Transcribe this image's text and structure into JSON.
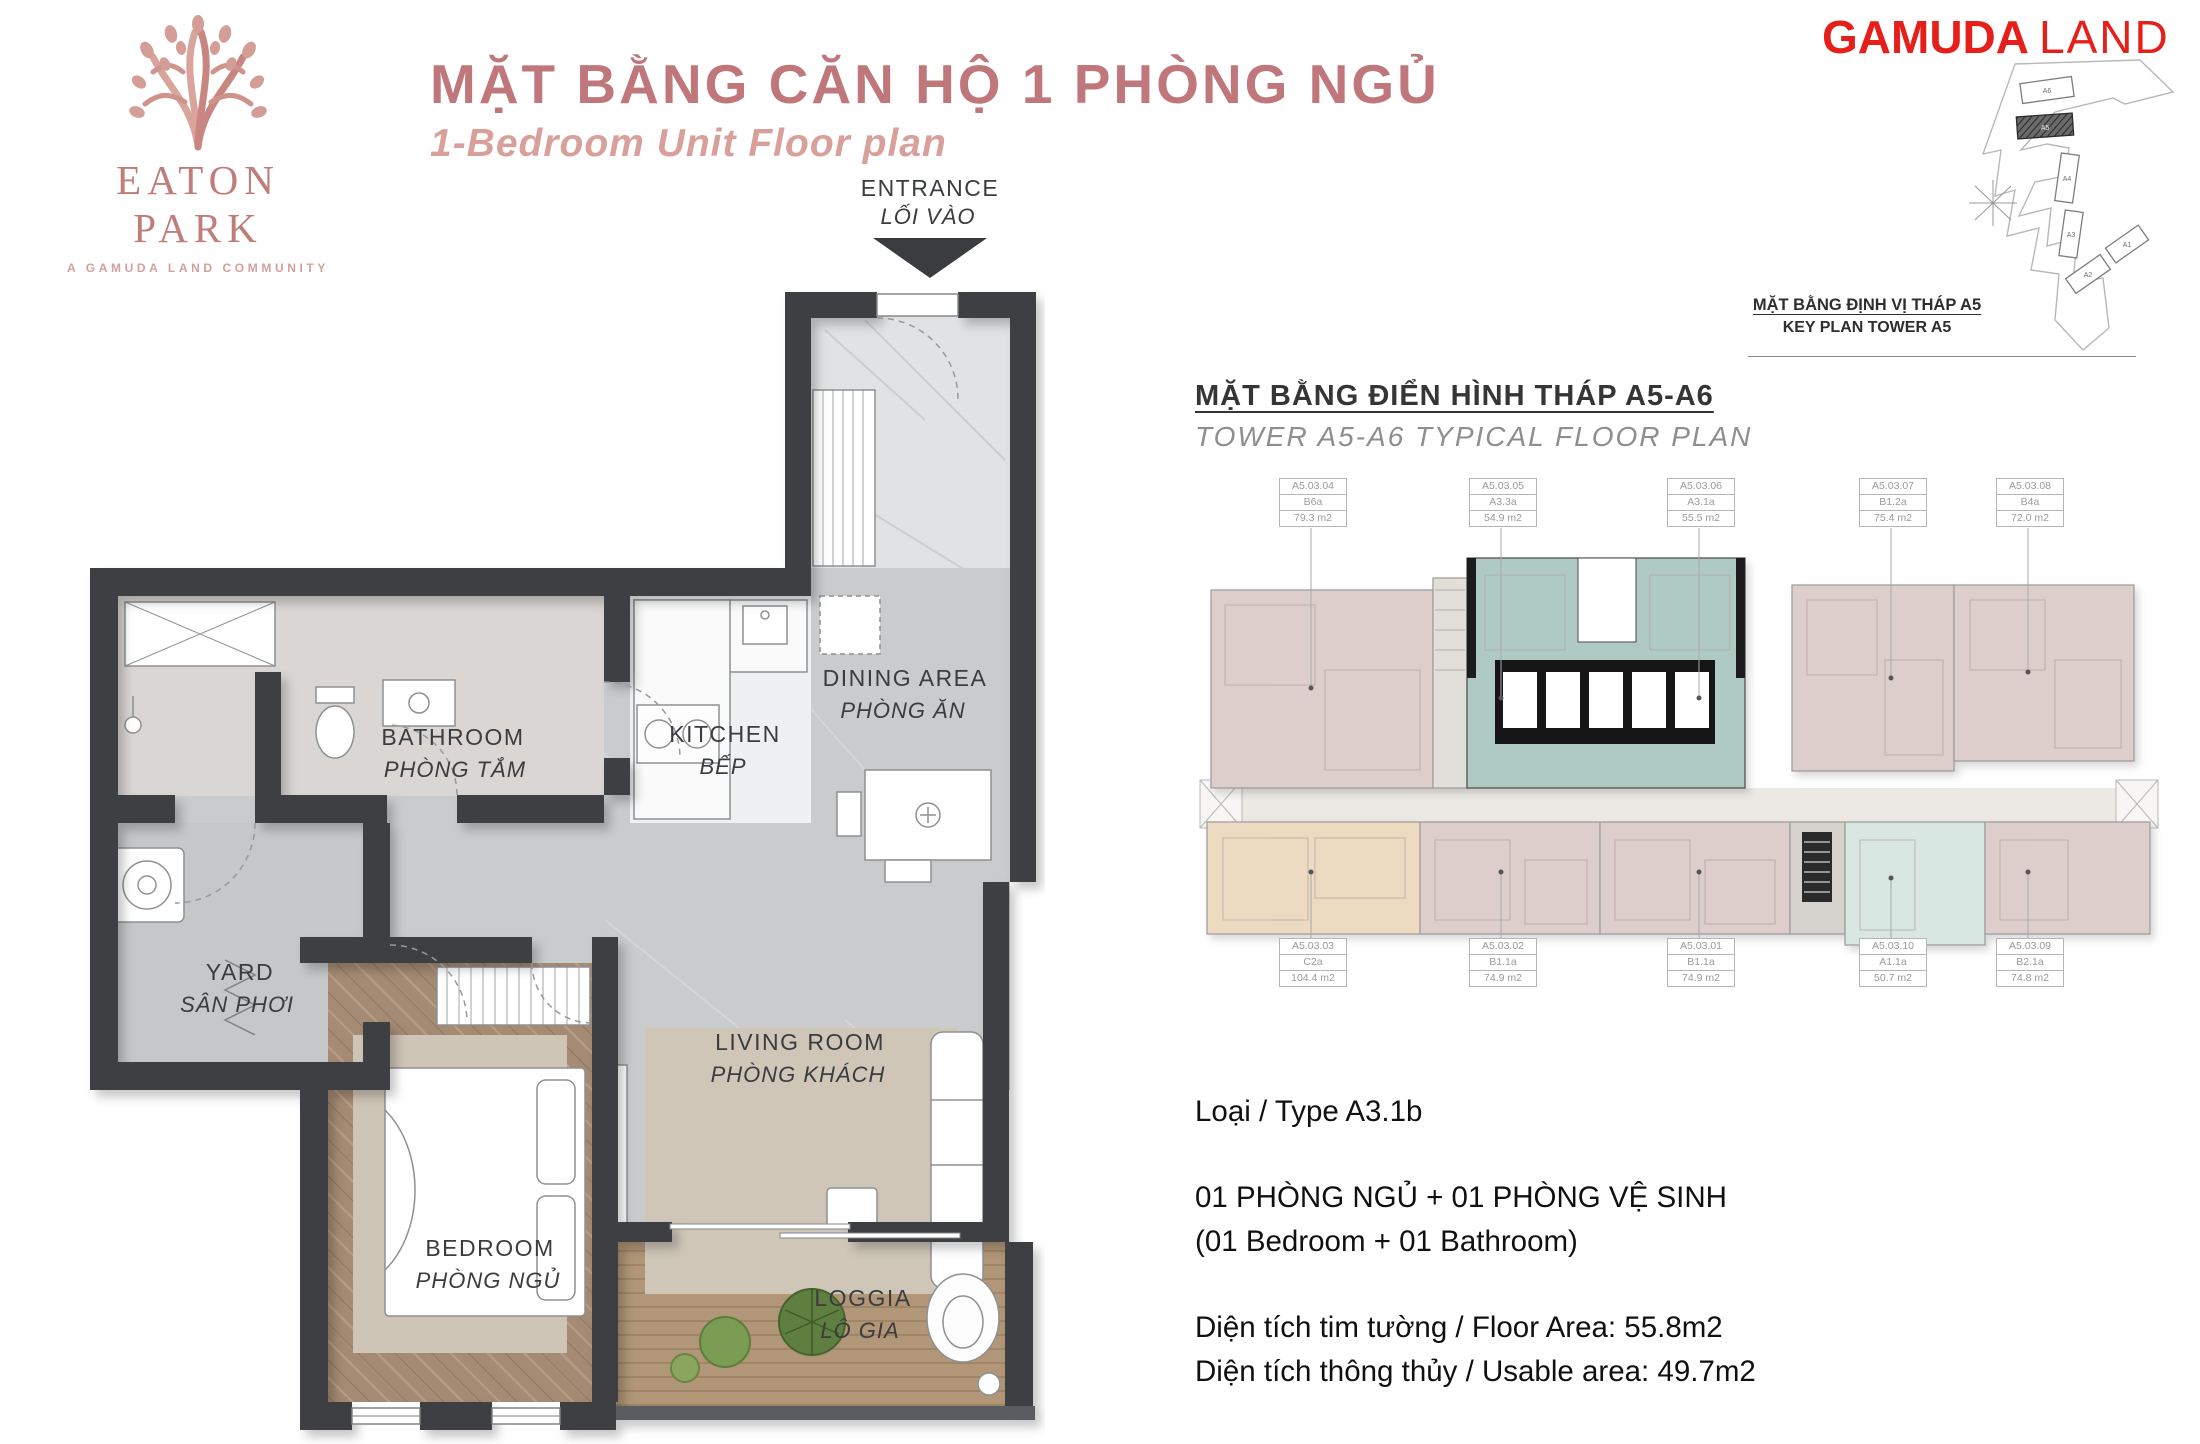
{
  "brand": {
    "eaton_name": "EATON PARK",
    "eaton_tagline": "A GAMUDA LAND COMMUNITY",
    "gamuda_bold": "GAMUDA",
    "gamuda_light": "LAND"
  },
  "header": {
    "title_vi": "MẶT BẰNG CĂN HỘ 1 PHÒNG NGỦ",
    "title_en": "1-Bedroom Unit Floor plan"
  },
  "key_plan": {
    "caption_vi": "MẶT BẰNG ĐỊNH VỊ THÁP A5",
    "caption_en": "KEY PLAN TOWER A5",
    "buildings": [
      "A6",
      "A5",
      "A4",
      "A3",
      "A1",
      "A2"
    ]
  },
  "unit_plan": {
    "entrance_en": "ENTRANCE",
    "entrance_vi": "LỐI VÀO",
    "rooms": {
      "bathroom": {
        "en": "BATHROOM",
        "vi": "PHÒNG TẮM"
      },
      "kitchen": {
        "en": "KITCHEN",
        "vi": "BẾP"
      },
      "dining": {
        "en": "DINING AREA",
        "vi": "PHÒNG ĂN"
      },
      "yard": {
        "en": "YARD",
        "vi": "SÂN PHƠI"
      },
      "bedroom": {
        "en": "BEDROOM",
        "vi": "PHÒNG NGỦ"
      },
      "living": {
        "en": "LIVING ROOM",
        "vi": "PHÒNG KHÁCH"
      },
      "loggia": {
        "en": "LOGGIA",
        "vi": "LÔ GIA"
      }
    }
  },
  "typical_plan": {
    "title_vi": "MẶT BẰNG ĐIỂN HÌNH THÁP A5-A6",
    "title_en": "TOWER A5-A6 TYPICAL FLOOR PLAN",
    "units_top": [
      {
        "code": "A5.03.04",
        "type": "B6a",
        "area": "79.3 m2"
      },
      {
        "code": "A5.03.05",
        "type": "A3.3a",
        "area": "54.9 m2"
      },
      {
        "code": "A5.03.06",
        "type": "A3.1a",
        "area": "55.5 m2"
      },
      {
        "code": "A5.03.07",
        "type": "B1.2a",
        "area": "75.4 m2"
      },
      {
        "code": "A5.03.08",
        "type": "B4a",
        "area": "72.0 m2"
      }
    ],
    "units_bottom": [
      {
        "code": "A5.03.03",
        "type": "C2a",
        "area": "104.4 m2"
      },
      {
        "code": "A5.03.02",
        "type": "B1.1a",
        "area": "74.9 m2"
      },
      {
        "code": "A5.03.01",
        "type": "B1.1a",
        "area": "74.9 m2"
      },
      {
        "code": "A5.03.10",
        "type": "A1.1a",
        "area": "50.7 m2"
      },
      {
        "code": "A5.03.09",
        "type": "B2.1a",
        "area": "74.8 m2"
      }
    ]
  },
  "unit_info": {
    "type_line": "Loại / Type A3.1b",
    "config_vi": "01 PHÒNG NGỦ + 01 PHÒNG VỆ SINH",
    "config_en": "(01 Bedroom + 01 Bathroom)",
    "floor_area": "Diện tích tim tường / Floor Area: 55.8m2",
    "usable_area": "Diện tích thông thủy / Usable area: 49.7m2"
  },
  "colors": {
    "title_rose": "#c0777b",
    "subtitle_rose": "#d9a09b",
    "gamuda_red": "#e71f1a",
    "wall_dark": "#3d3f42",
    "floor_gray": "#c9cbcd",
    "unit_teal": "#aecac3",
    "unit_teal_light": "#d8e7e1",
    "unit_pink": "#ddcecb",
    "unit_beige": "#ecdbc1",
    "corridor": "#ece9e5"
  }
}
